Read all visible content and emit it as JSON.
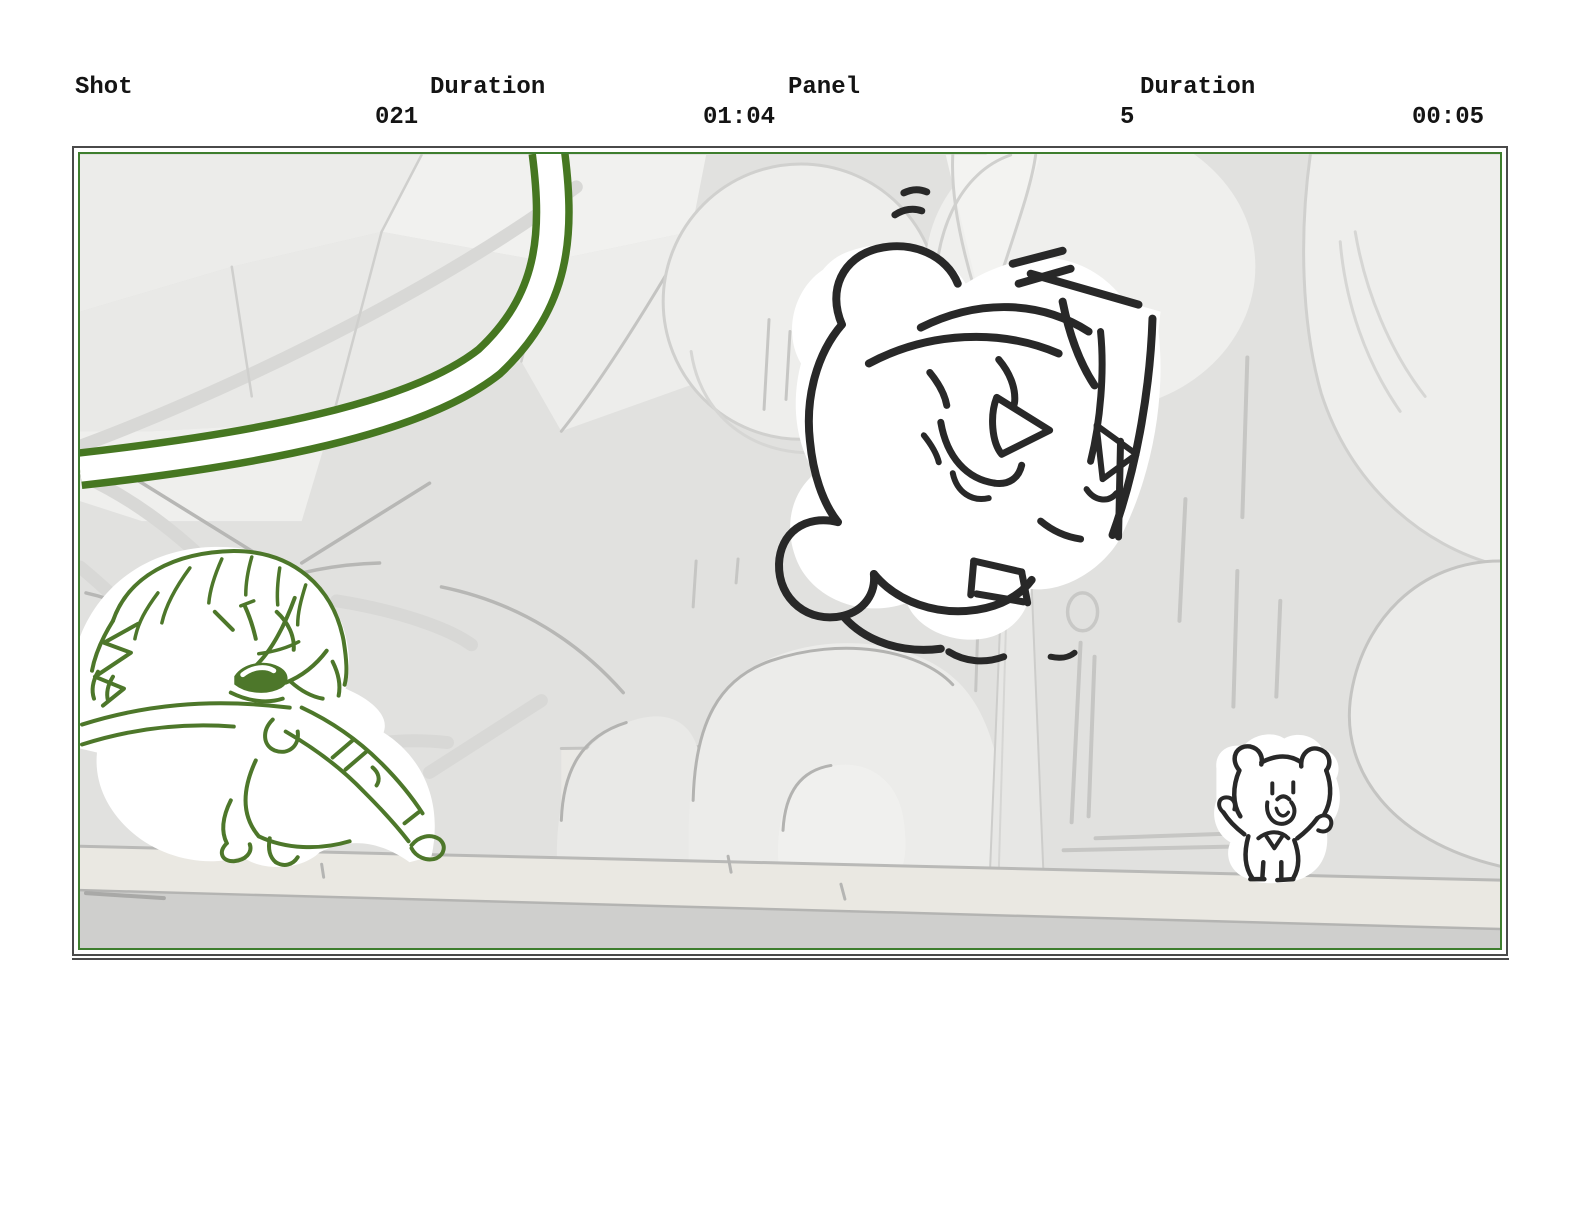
{
  "header": {
    "shot_label": "Shot",
    "shot_value": "021",
    "shot_duration_label": "Duration",
    "shot_duration_value": "01:04",
    "panel_label": "Panel",
    "panel_value": "5",
    "panel_duration_label": "Duration",
    "panel_duration_value": "00:05"
  },
  "colors": {
    "frame_green": "#3e7e2e",
    "outer_border": "#4a4a4a",
    "sketch_green": "#4d772a",
    "vine_green": "#467721",
    "ink": "#282828",
    "canvas_bg": "#e1e1df",
    "ground_light": "#eae8e2",
    "ground_dark": "#cfcfcd",
    "text_color": "#141414",
    "page_bg": "#ffffff"
  }
}
